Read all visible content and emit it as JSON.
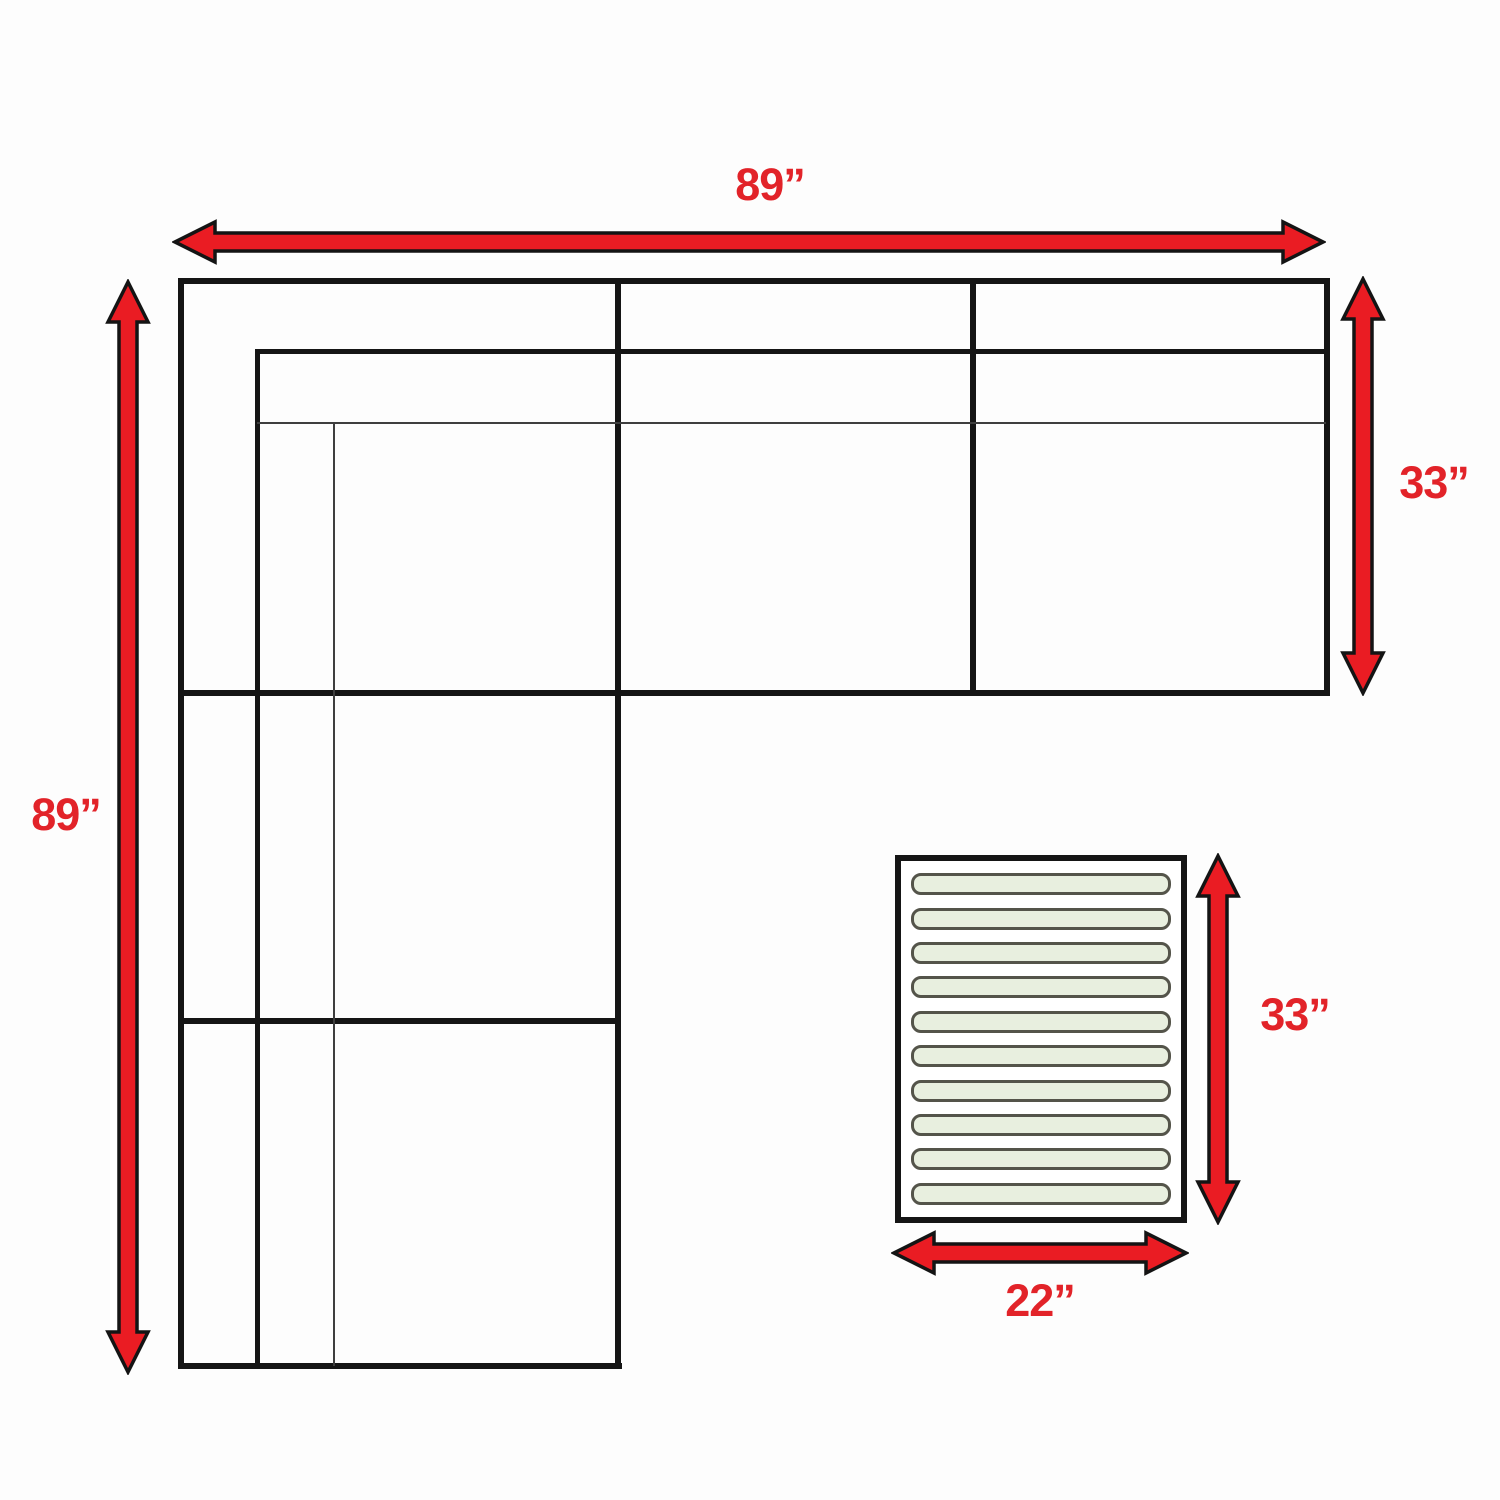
{
  "diagram": {
    "kind": "sectional-sofa-dimension-diagram",
    "labels": {
      "sofa_width": "89”",
      "sofa_depth": "89”",
      "chaise_depth": "33”",
      "ottoman_depth": "33”",
      "ottoman_width": "22”"
    },
    "ottoman": {
      "slat_count": 10
    },
    "colors": {
      "arrow_red": "#ea1c23",
      "label_red": "#e22329",
      "line_black": "#151515",
      "line_thin": "#3e3e3e",
      "slat_fill": "#e8efdf",
      "slat_border": "#54544a"
    }
  }
}
